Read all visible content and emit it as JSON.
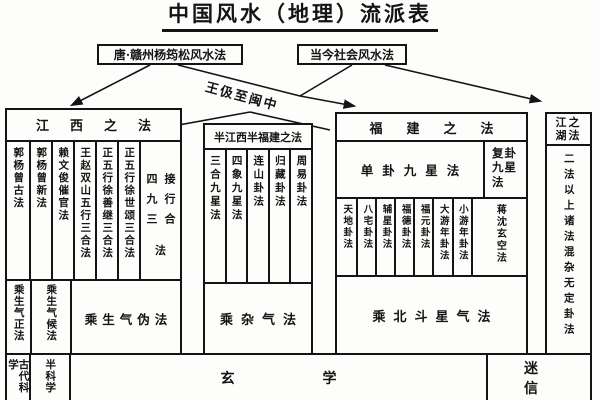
{
  "title": "中国风水（地理）流派表",
  "top": {
    "left_box": "唐·赣州杨筠松风水法",
    "right_box": "当今社会风水法",
    "arrow_label": "王伋至闽中"
  },
  "jiangxi": {
    "header": "江西之法",
    "columns": [
      "郭杨曾古法",
      "郭杨曾新法",
      "赖文俊催官法",
      "王赵双山五行三合法",
      "正五行徐善继三合法",
      "正五行徐世颂三合法"
    ],
    "wide_column": {
      "right_line": "接行合",
      "left_line": "四九三",
      "tail": "法"
    },
    "qi_row": [
      "乘生气正法",
      "乘生气候法",
      "乘生气伪法"
    ]
  },
  "mixed": {
    "header": "半江西半福建之法",
    "columns": [
      "三合九星法",
      "四象九星法",
      "连山卦法",
      "归藏卦法",
      "周易卦法"
    ],
    "qi_row": "乘杂气法"
  },
  "fujian": {
    "header": "福建之法",
    "sub_headers": [
      "单卦九星法",
      "复卦九星法"
    ],
    "columns": [
      "天地卦法",
      "八宅卦法",
      "辅星卦法",
      "福德卦法",
      "福元卦法",
      "大游年卦法",
      "小游年卦法"
    ],
    "fugua_column": "蒋沈玄空法",
    "qi_row": "乘北斗星气法"
  },
  "jianghu": {
    "header_lines": [
      "江之",
      "湖法"
    ],
    "body": "二法以上诸法混杂无定卦法"
  },
  "bottom_row": [
    "古代科学",
    "半科学",
    "玄学",
    "迷信"
  ]
}
